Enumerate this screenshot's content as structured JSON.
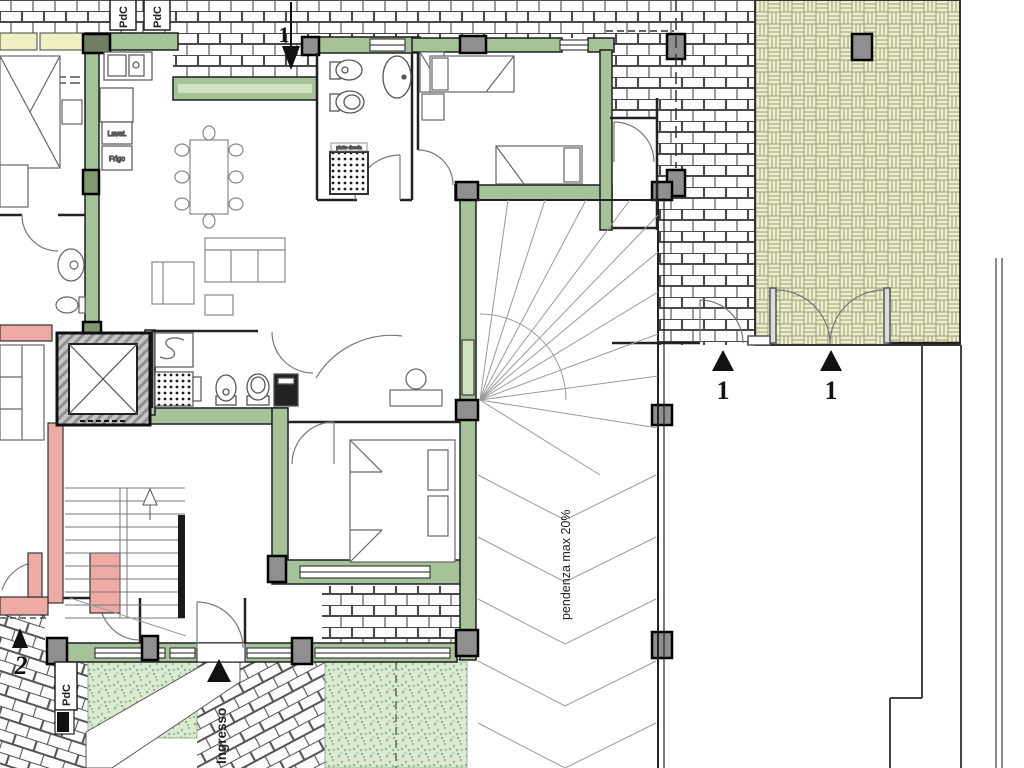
{
  "plan": {
    "labels": {
      "pdc": "PdC",
      "ingresso": "Ingresso",
      "ramp_slope": "pendenza max 20%",
      "kitchen_washer": "Lavat.",
      "kitchen_fridge": "Frigo",
      "shower_tray": "piatto doccia"
    },
    "markers": {
      "section_top": "1",
      "courtyard_left": "1",
      "courtyard_right": "1",
      "bottom_left": "2"
    },
    "colors": {
      "wall_green": "#a6c298",
      "sill_green": "#cfe2c2",
      "courtyard_bg": "#eef0cd",
      "grass_bg": "#dcead2",
      "pink_wall": "#eeaaa4",
      "yellow_sill": "#efefc2",
      "brick_joint": "#4a4a4a",
      "line_dark": "#1f1f1f",
      "pillar_gray": "#8f8f8f"
    }
  }
}
